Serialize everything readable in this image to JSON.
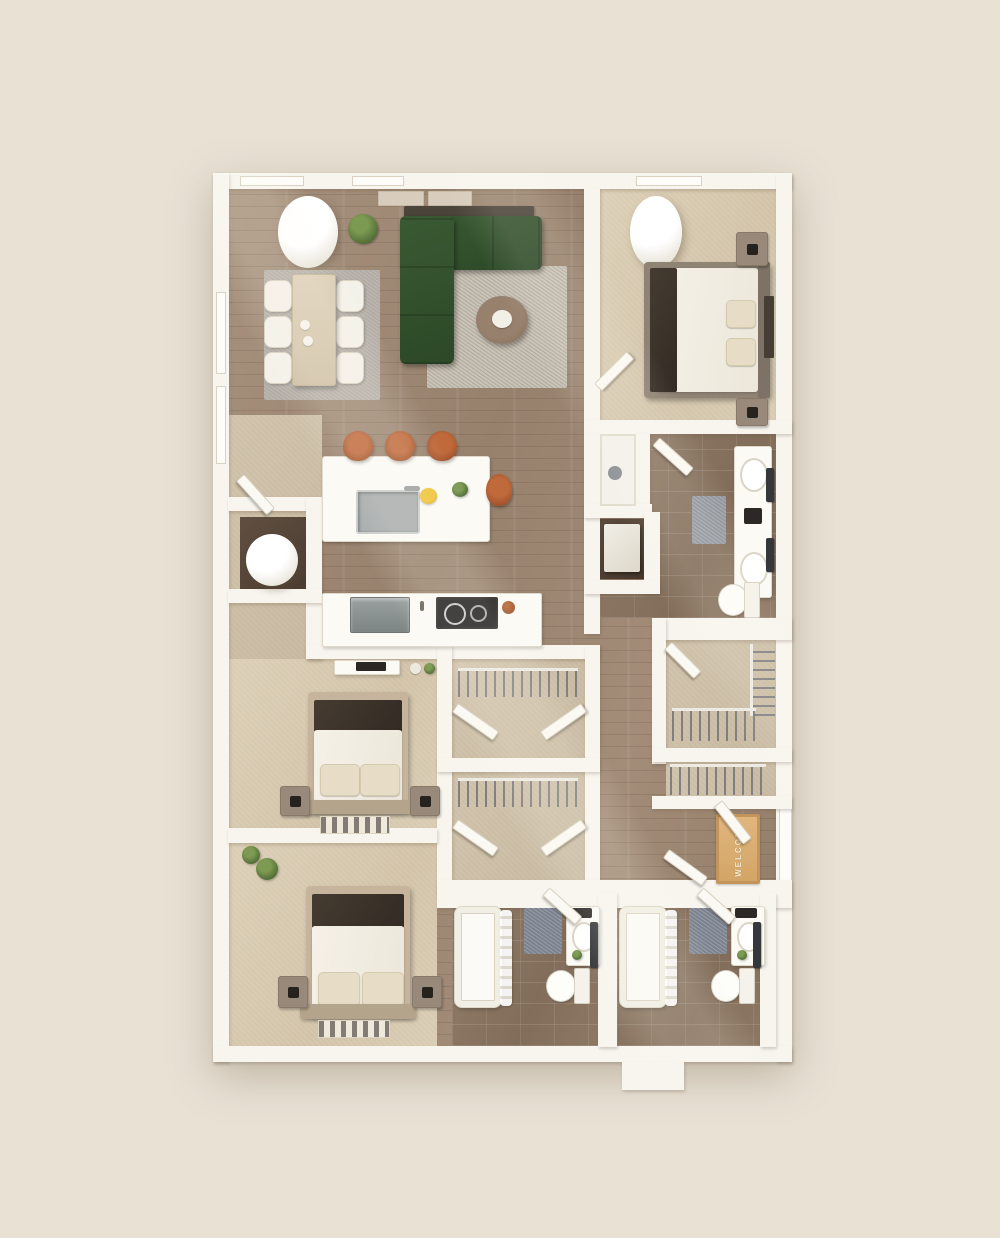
{
  "scene": {
    "type": "floor-plan-3d-top-down",
    "description": "Photorealistic top-down 3D render of a three-bedroom apartment floor plan on a plain beige background",
    "rooms": [
      "living-room",
      "dining-area",
      "kitchen",
      "primary-bedroom",
      "primary-bathroom",
      "walk-in-closet",
      "linen-closet",
      "entry-corridor",
      "bedroom-2",
      "bedroom-3",
      "bathroom-2",
      "bathroom-3",
      "utility-closet",
      "hall-closets",
      "hallway"
    ],
    "furniture": [
      "dining-table-with-6-chairs",
      "green-l-shaped-sectional-sofa",
      "round-coffee-table",
      "kitchen-island-with-sink-and-3-bar-stools",
      "refrigerator",
      "cooktop",
      "3-beds-with-nightstands",
      "double-vanity",
      "2-bathtubs",
      "3-toilets",
      "2-shower",
      "water-heater",
      "hanging-rods-with-clothes-hangers",
      "welcome-mat",
      "white-structural-columns",
      "potted-plants"
    ]
  },
  "entry": {
    "mat_text": "WELCOME"
  },
  "palette": {
    "background": "#e8e1d4",
    "wall": "#f8f5ef",
    "wood_floor": "#a08b78",
    "tile_floor": "#8c7663",
    "carpet": "#d8cbb2",
    "closet_floor": "#cbbda5",
    "rug_living": "#c9c2b6",
    "rug_dining": "#b4aea6",
    "rug_bath": "#7c838e",
    "sofa_green": "#33512d",
    "stool_leather": "#b05c31",
    "coffee_table": "#8a7260",
    "mat_orange": "#d3a566",
    "dark_accent": "#3a342e",
    "appliance_gray": "#8e9292",
    "cooktop_black": "#1e1d1c",
    "plant_green": "#5f7d3c",
    "duvet_white": "#f2eee5",
    "nightstand": "#99897a"
  }
}
